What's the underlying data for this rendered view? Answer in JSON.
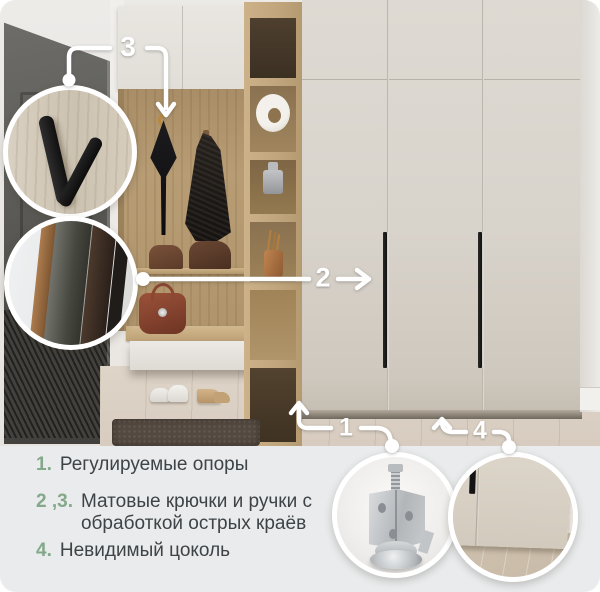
{
  "callouts": {
    "c1": "1",
    "c2": "2",
    "c3": "3",
    "c4": "4"
  },
  "legend": {
    "items": [
      {
        "num": "1.",
        "text": "Регулируемые опоры"
      },
      {
        "num": "2 ,3.",
        "text": "Матовые крючки и ручки с обработкой острых краёв"
      },
      {
        "num": "4.",
        "text": "Невидимый цоколь"
      }
    ]
  },
  "insets": [
    {
      "name": "hook-closeup-inset"
    },
    {
      "name": "edge-finish-closeup-inset"
    },
    {
      "name": "leveling-foot-closeup-inset"
    },
    {
      "name": "invisible-plinth-closeup-inset"
    }
  ],
  "colors": {
    "accent_green": "#84a88a",
    "legend_panel_bg": "#e9ebec",
    "callout_white": "#ffffff",
    "wardrobe_cream": "#d8d3cb",
    "wood_oak": "#b79c74",
    "handle_black": "#1c1b1a",
    "door_gray": "#565550",
    "floor": "#d9cfc3",
    "rug_brown": "#544940",
    "legend_text": "#3e4347"
  }
}
